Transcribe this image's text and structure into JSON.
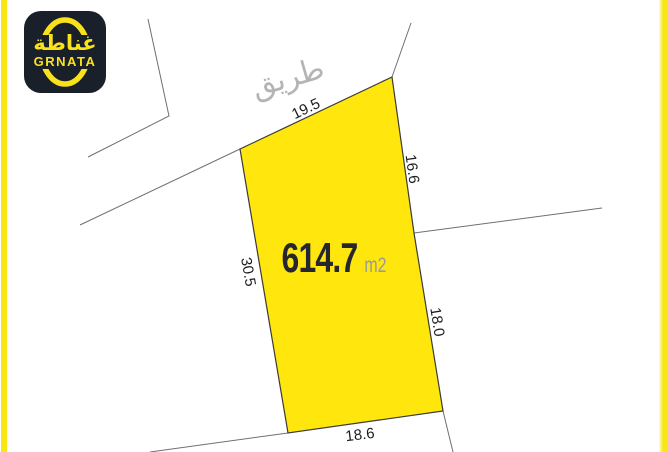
{
  "brand": {
    "logo_arabic": "غناطة",
    "logo_latin": "GRNATA",
    "logo_bg_color": "#1A202A",
    "logo_accent_color": "#F9E21C"
  },
  "map": {
    "road_label": "طريق",
    "area": {
      "value": "614.7",
      "unit": "m2"
    },
    "dimensions": {
      "top": "19.5",
      "upper_right": "16.6",
      "left": "30.5",
      "lower_right": "18.0",
      "bottom": "18.6"
    },
    "colors": {
      "plot_fill": "#FFE60D",
      "plot_stroke": "#3A3A3A",
      "boundary_line": "#707070",
      "frame_bar": "#F7E713",
      "road_text": "#B4B4B4",
      "dimension_text": "#1C1C1C",
      "area_value_text": "#26262E",
      "area_unit_text": "#9A9A9A"
    }
  }
}
